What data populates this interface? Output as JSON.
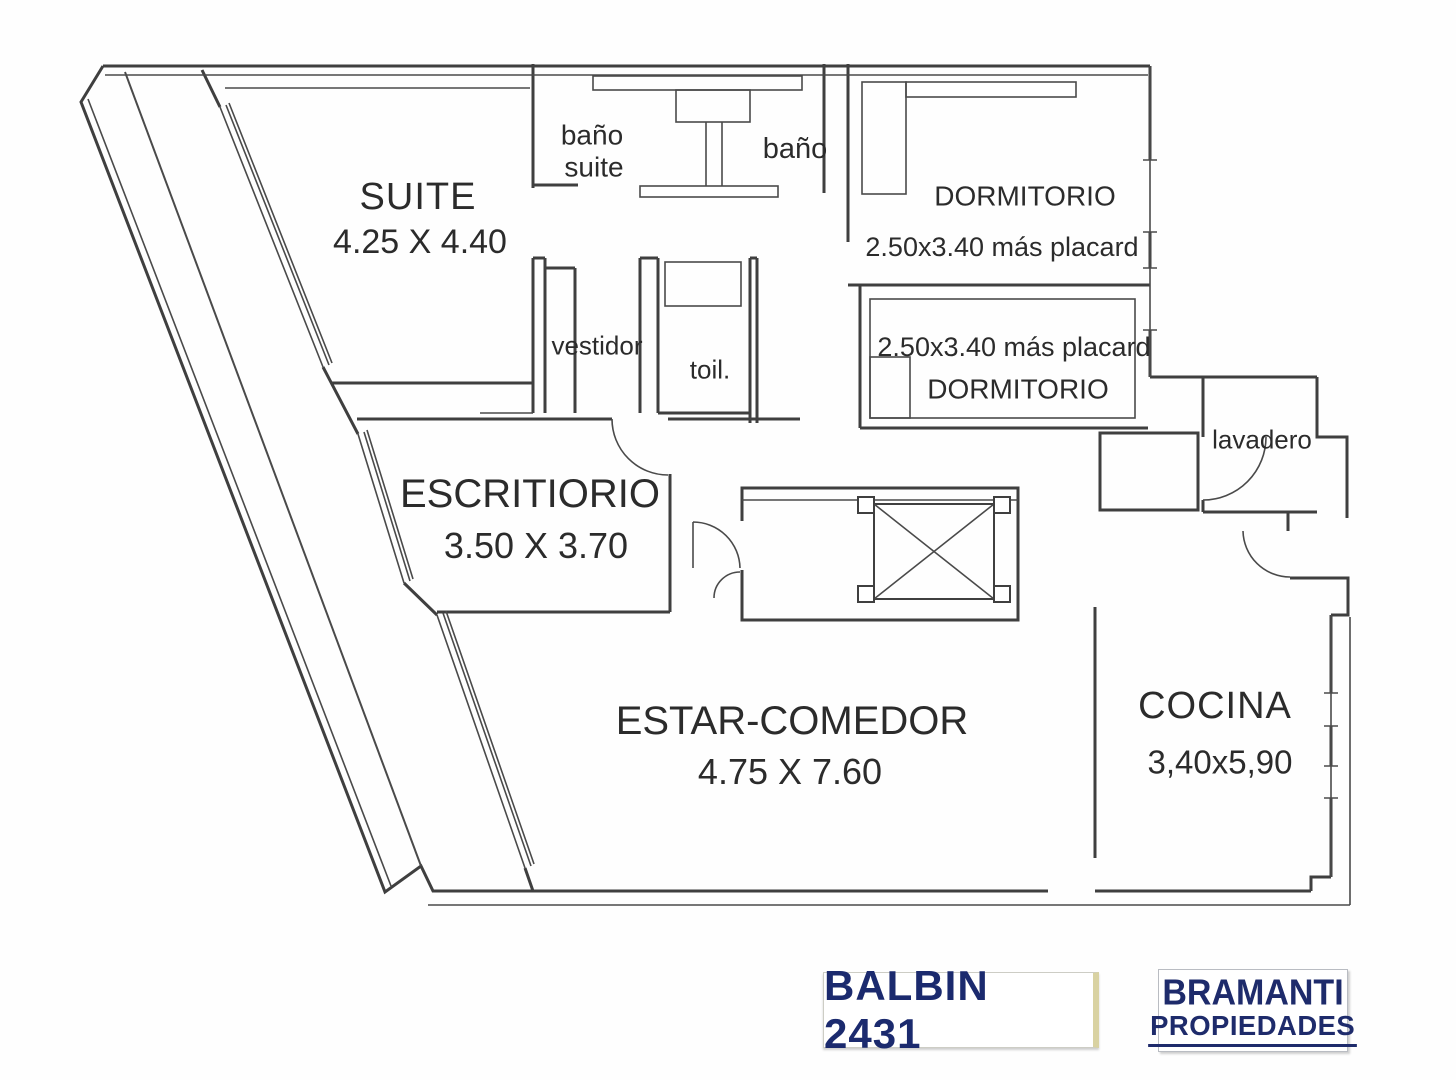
{
  "rooms": {
    "suite": {
      "name": "SUITE",
      "dims": "4.25 X 4.40"
    },
    "bano_suite": {
      "line1": "baño",
      "line2": "suite"
    },
    "bano": {
      "name": "baño"
    },
    "dormitorio_1": {
      "name": "DORMITORIO",
      "dims": "2.50x3.40 más placard"
    },
    "dormitorio_2": {
      "name": "DORMITORIO",
      "dims": "2.50x3.40 más placard"
    },
    "vestidor": {
      "name": "vestidor"
    },
    "toilette": {
      "name": "toil."
    },
    "lavadero": {
      "name": "lavadero"
    },
    "escritorio": {
      "name": "ESCRITIORIO",
      "dims": "3.50 X 3.70"
    },
    "estar_comedor": {
      "name": "ESTAR-COMEDOR",
      "dims": "4.75 X 7.60"
    },
    "cocina": {
      "name": "COCINA",
      "dims": "3,40x5,90"
    }
  },
  "footer": {
    "address_label": "BALBIN 2431",
    "brand_name": "BRAMANTI",
    "brand_subtitle": "PROPIEDADES"
  },
  "colors": {
    "wall_line": "#3f3f3f",
    "thin_line": "#4a4a4a",
    "label_text": "#2b2b2b",
    "navy_text": "#1b2a6e",
    "plate_shadow_tan": "#d9d2a2"
  }
}
